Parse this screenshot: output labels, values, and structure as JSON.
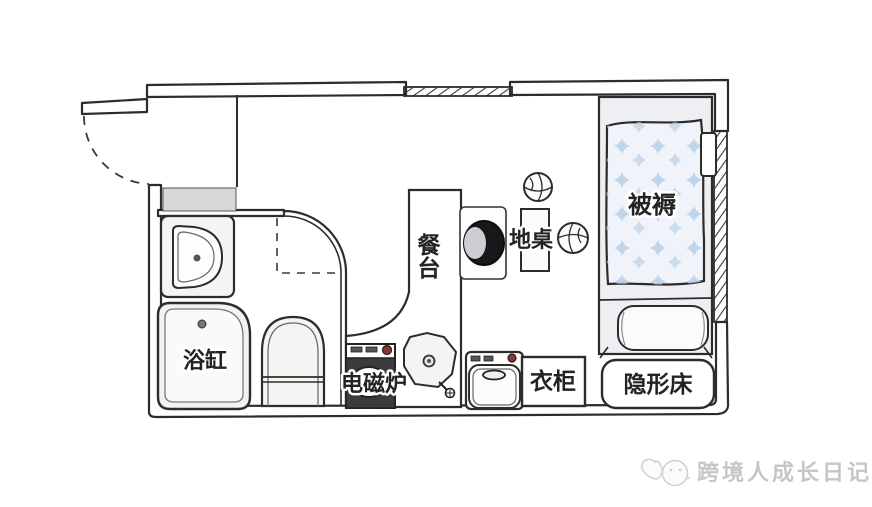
{
  "labels": {
    "bedding": "被褥",
    "floor_table": "地桌",
    "dining_counter": "餐台",
    "bathtub": "浴缸",
    "induction_cooker": "电磁炉",
    "wardrobe": "衣柜",
    "hidden_bed": "隐形床"
  },
  "watermark": {
    "brand": "跨境人成长日记"
  },
  "colors": {
    "ink": "#2e2c29",
    "futon_base": "#f0f4fa",
    "futon_star_blue": "#b9cfe8",
    "bed_platform": "#edeff3",
    "fixture_gray": "#f2f2f1",
    "step_gray": "#d7d8d9",
    "appliance_dark": "#3b3b3d",
    "knob_red": "#8e3431",
    "chair_dark": "#18181b",
    "watermark_gray": "#c6c6c6"
  }
}
